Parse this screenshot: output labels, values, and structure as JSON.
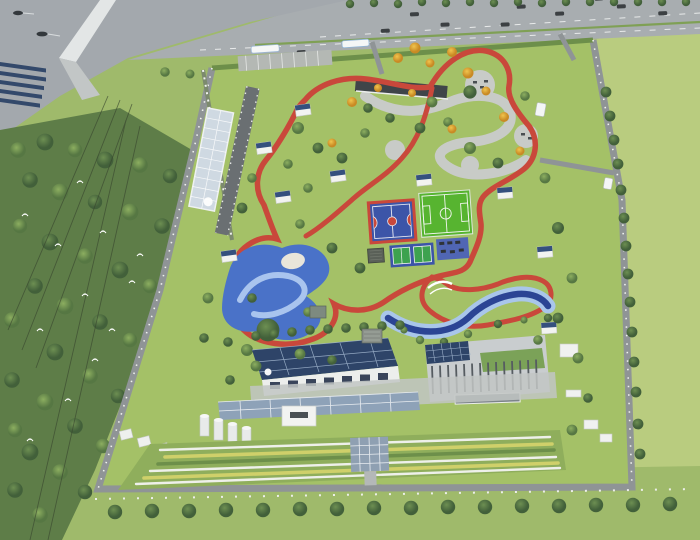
{
  "scene": {
    "kind": "aerial-architectural-rendering",
    "subject": "sports-park-campus",
    "features": [
      "canal-with-boats",
      "highway-with-cars",
      "bridge",
      "forest-with-birds",
      "power-lines",
      "substation-solar-array",
      "greenhouse",
      "entrance-plaza",
      "canopy-building",
      "running-track",
      "basketball-court",
      "soccer-field",
      "tennis-courts",
      "fitness-area",
      "playground",
      "sand-pit",
      "stream",
      "pavilions",
      "solar-roof-building",
      "louvered-building",
      "green-roof",
      "solar-carport",
      "storage-tanks",
      "garden-beds",
      "solar-ramp",
      "meadow",
      "tree-rows"
    ]
  },
  "colors": {
    "lawn": "#a4c167",
    "meadow": "#b9cc7f",
    "outer_grass": "#9fba6b",
    "verge_green": "#8fae5e",
    "forest": "#5e7d48",
    "canal": "#a3a8ad",
    "highway": "#a8adb0",
    "road": "#8f9496",
    "plaza": "#c8cbc7",
    "track_red": "#c9483b",
    "court_blue": "#3c55a8",
    "soccer_green": "#57b430",
    "tennis_green": "#3da24f",
    "fitness_blue": "#5066b4",
    "playground_blue": "#4a72c8",
    "playground_path": "#a9c4ee",
    "stream_dark": "#2b4494",
    "stream_light": "#a9c6ea",
    "solar_panel": "#2e4468",
    "building_white": "#eceeec",
    "building_gray": "#c9cdcf",
    "roof_dark": "#3f4549",
    "green_roof": "#7ba258",
    "autumn": "#e2a832",
    "sand": "#e9e5da",
    "garden_base": "#8fae5c",
    "bridge": "#e3e6e6"
  }
}
